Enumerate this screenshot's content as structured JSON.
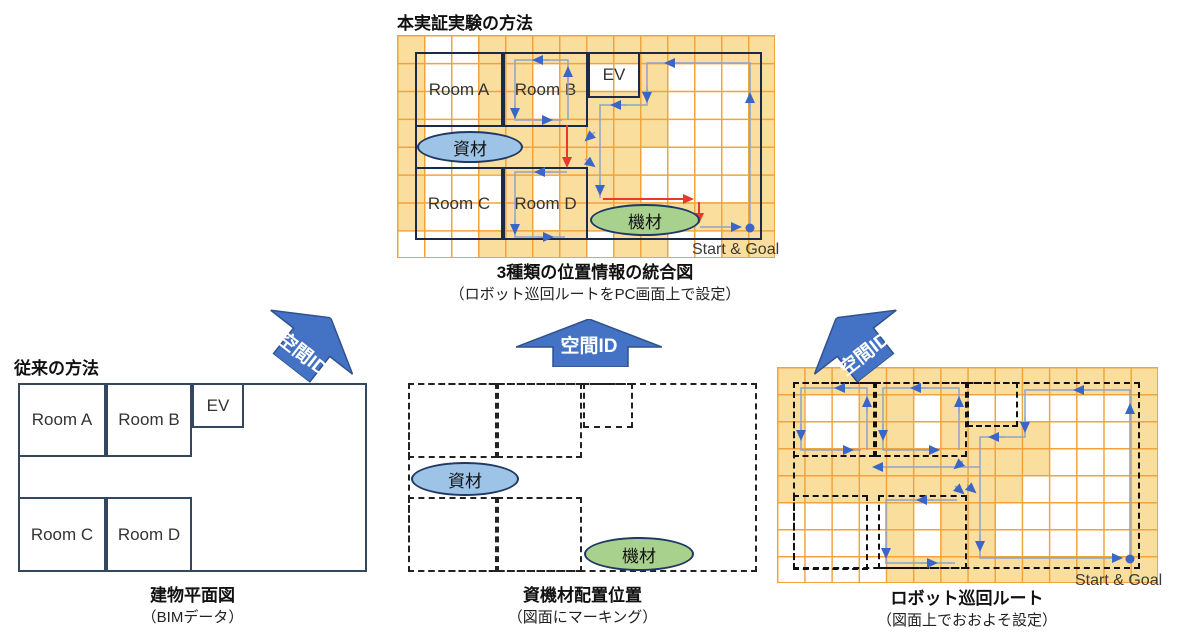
{
  "headings": {
    "experiment": "本実証実験の方法",
    "conventional": "従来の方法"
  },
  "captions": {
    "integrated_title": "3種類の位置情報の統合図",
    "integrated_sub": "（ロボット巡回ルートをPC画面上で設定）",
    "floorplan_title": "建物平面図",
    "floorplan_sub": "（BIMデータ）",
    "materials_title": "資機材配置位置",
    "materials_sub": "（図面にマーキング）",
    "route_title": "ロボット巡回ルート",
    "route_sub": "（図面上でおおよそ設定）"
  },
  "labels": {
    "room_a": "Room A",
    "room_b": "Room B",
    "room_c": "Room C",
    "room_d": "Room D",
    "ev": "EV",
    "materials": "資材",
    "equipment": "機材",
    "start_goal": "Start & Goal",
    "spatial_id": "空間ID"
  },
  "colors": {
    "grid_line": "#F2A33C",
    "cell_highlight": "#FADE9E",
    "route_line": "#8FA3C8",
    "arrow_blue": "#3A66C8",
    "arrow_red": "#E8392B",
    "block_arrow_fill": "#4472C4",
    "block_arrow_border": "#2F528F",
    "materials_fill": "#9DC3E6",
    "equipment_fill": "#A9D18E",
    "oval_border": "#1F3864",
    "plan_line": "#1b2a4a"
  },
  "grids": {
    "top": {
      "cols": 14,
      "rows": 8,
      "cells": [
        "10011111111111",
        "10011010010001",
        "10011011110001",
        "10011111110001",
        "10011111100001",
        "10001011100001",
        "10001011111111",
        "00011110110011"
      ]
    },
    "route": {
      "cols": 14,
      "rows": 8,
      "cells": [
        "11111111111111",
        "10011010000001",
        "10011011110001",
        "11111111110001",
        "11111111100001",
        "00001011000001",
        "00001011000001",
        "00001111111111"
      ]
    }
  }
}
